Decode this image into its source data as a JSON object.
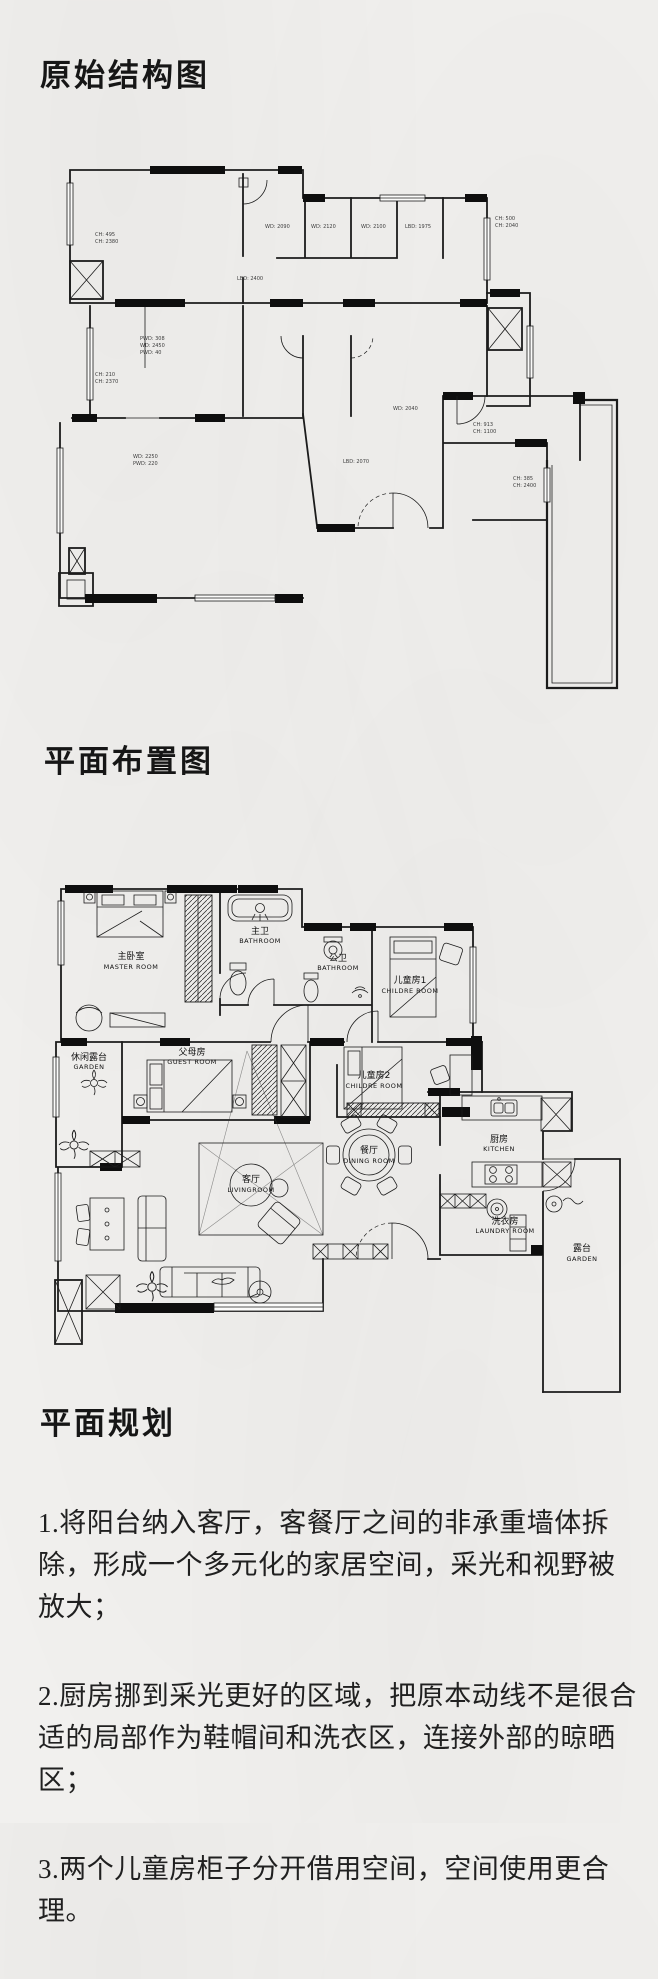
{
  "page": {
    "background": "#f1f0ee",
    "ink": "#1a1a1a"
  },
  "titles": {
    "original": "原始结构图",
    "layout": "平面布置图",
    "planning": "平面规划"
  },
  "planning_notes": [
    "1.将阳台纳入客厅，客餐厅之间的非承重墙体拆除，形成一个多元化的家居空间，采光和视野被放大；",
    "2.厨房挪到采光更好的区域，把原本动线不是很合适的局部作为鞋帽间和洗衣区，连接外部的晾晒区；",
    "3.两个儿童房柜子分开借用空间，空间使用更合理。"
  ],
  "plan1": {
    "dim_labels": [
      "CH: 495",
      "CH: 2380",
      "PWD: 308",
      "WD: 2450",
      "PWD: 40",
      "LBD: 2400",
      "WD: 2090",
      "WD: 2120",
      "WD: 2100",
      "LBD: 1975",
      "CH: 500",
      "CH: 2040",
      "CH: 210",
      "CH: 2370",
      "WD: 2250",
      "PWD: 220",
      "LBD: 2070",
      "CH: 913",
      "CH: 1100",
      "CH: 385",
      "CH: 2400",
      "WD: 2040"
    ]
  },
  "plan2": {
    "rooms": [
      {
        "zh": "主卧室",
        "en": "MASTER ROOM"
      },
      {
        "zh": "主卫",
        "en": "BATHROOM"
      },
      {
        "zh": "公卫",
        "en": "BATHROOM"
      },
      {
        "zh": "儿童房1",
        "en": "CHILDRE ROOM"
      },
      {
        "zh": "休闲露台",
        "en": "GARDEN"
      },
      {
        "zh": "父母房",
        "en": "GUEST ROOM"
      },
      {
        "zh": "儿童房2",
        "en": "CHILDRE ROOM"
      },
      {
        "zh": "餐厅",
        "en": "DINING ROOM"
      },
      {
        "zh": "厨房",
        "en": "KITCHEN"
      },
      {
        "zh": "客厅",
        "en": "LIVINGROOM"
      },
      {
        "zh": "洗衣房",
        "en": "LAUNDRY ROOM"
      },
      {
        "zh": "露台",
        "en": "GARDEN"
      }
    ]
  }
}
